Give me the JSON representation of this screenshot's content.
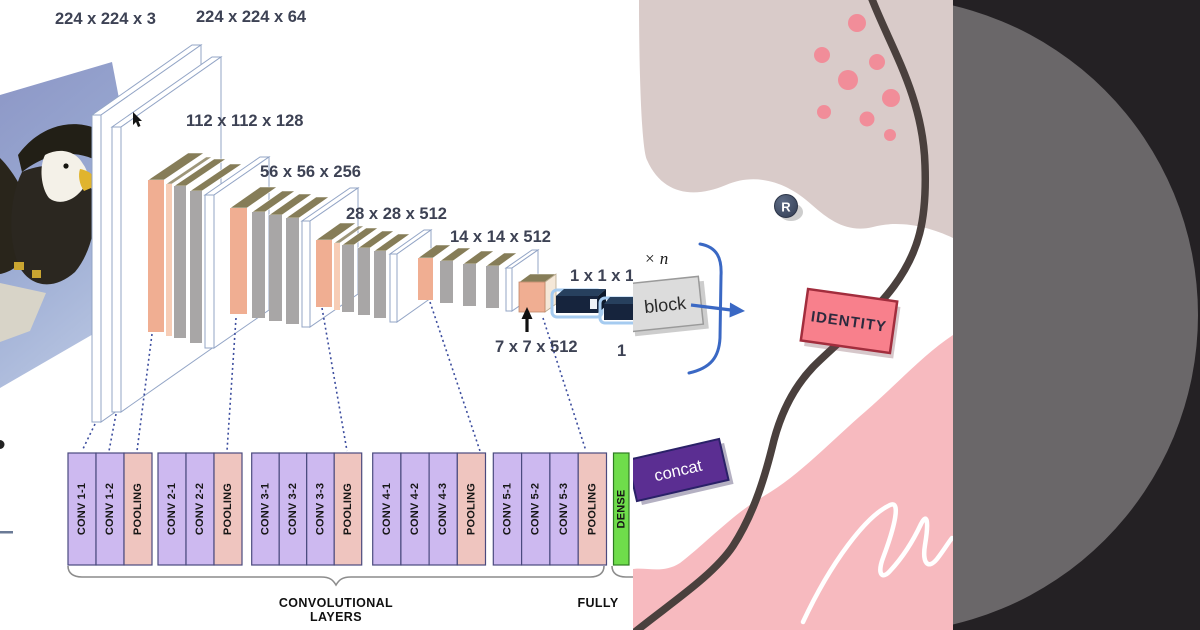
{
  "card": {
    "vgg": {
      "dim_labels": {
        "input": "224 x 224 x 3",
        "block1": "224 x 224 x 64",
        "block2": "112 x 112 x 128",
        "block3": "56 x 56 x 256",
        "block4": "28 x 28 x 512",
        "block5": "14 x 14 x 512",
        "fc": "1 x 1 x 1",
        "pool5": "7 x 7 x 512",
        "fc2": "1"
      },
      "layer_boxes": [
        "CONV 1-1",
        "CONV 1-2",
        "POOLING",
        "CONV 2-1",
        "CONV 2-2",
        "POOLING",
        "CONV 3-1",
        "CONV 3-2",
        "CONV 3-3",
        "POOLING",
        "CONV 4-1",
        "CONV 4-2",
        "CONV 4-3",
        "POOLING",
        "CONV 5-1",
        "CONV 5-2",
        "CONV 5-3",
        "POOLING",
        "DENSE"
      ],
      "group_labels": {
        "convolutional_line1": "CONVOLUTIONAL",
        "convolutional_line2": "LAYERS",
        "fully": "FULLY"
      },
      "input_photo": "bald-eagle"
    },
    "poster": {
      "repeat_label": "× n",
      "block_label": "block",
      "identity_label": "IDENTITY",
      "concat_label": "concat",
      "registered_badge": "R"
    },
    "icons": {
      "up_arrow": "↑",
      "flow_arrow": "→",
      "registered_badge": "R",
      "mouse_cursor": "arrow-cursor"
    },
    "colors": {
      "conv_box_fill": "#cdb9f0",
      "pooling_box_fill": "#efc5bf",
      "dense_box_fill": "#6fdd4b",
      "box_border": "#4a4a7e",
      "slab_salmon": "#f0ae92",
      "slab_olive_top": "#867d58",
      "slab_gray": "#a8a6a6",
      "fc_bar_navy": "#16243d",
      "fc_bar_glow": "#a5cbf0",
      "dotted_line": "#3c4d9e",
      "dim_label_text": "#3d4254",
      "poster_beige": "#d9cbc9",
      "poster_pink": "#f7babf",
      "poster_dot_pink": "#f18d99",
      "poster_line_brown": "#4a403d",
      "identity_fill": "#f8808c",
      "identity_border": "#a22d3d",
      "concat_fill": "#5b2e92",
      "concat_border": "#2a2168",
      "block_fill": "#dcdcdc",
      "flow_arrow_blue": "#3a68c4",
      "badge_navy": "#3f4a61",
      "panel_dark": "#242124",
      "panel_circle_gray": "#6a6769"
    }
  }
}
